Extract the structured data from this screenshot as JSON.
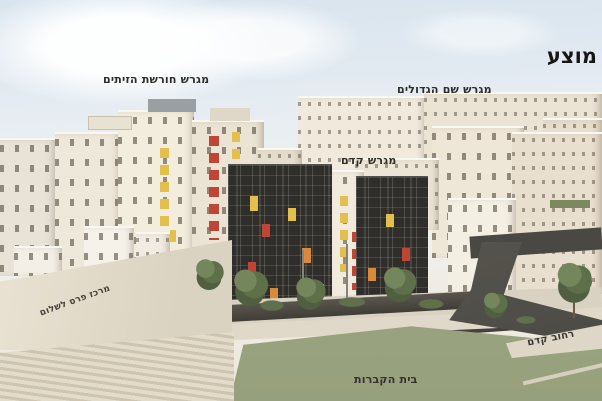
{
  "title": "מוצע",
  "annotations": {
    "olive_grove_lot": "מגרש חורשת הזיתים",
    "shem_hagdolim_lot": "מגרש שם הגדולים",
    "kedem_lot": "מגרש קדם",
    "peres_center": "מרכז פרס לשלום",
    "kedem_street": "רחוב קדם",
    "cemetery": "בית הקברות"
  },
  "colors": {
    "sky_top": "#d8e4ee",
    "building_cream": "#ece5d8",
    "accent_yellow": "#e3bf4e",
    "accent_red": "#bf4536",
    "accent_orange": "#d88a3a",
    "grid_dark": "#2f2e2b",
    "field_green": "#97a07c",
    "road_dark": "#4b4944",
    "tree_green": "#4f5f40"
  }
}
